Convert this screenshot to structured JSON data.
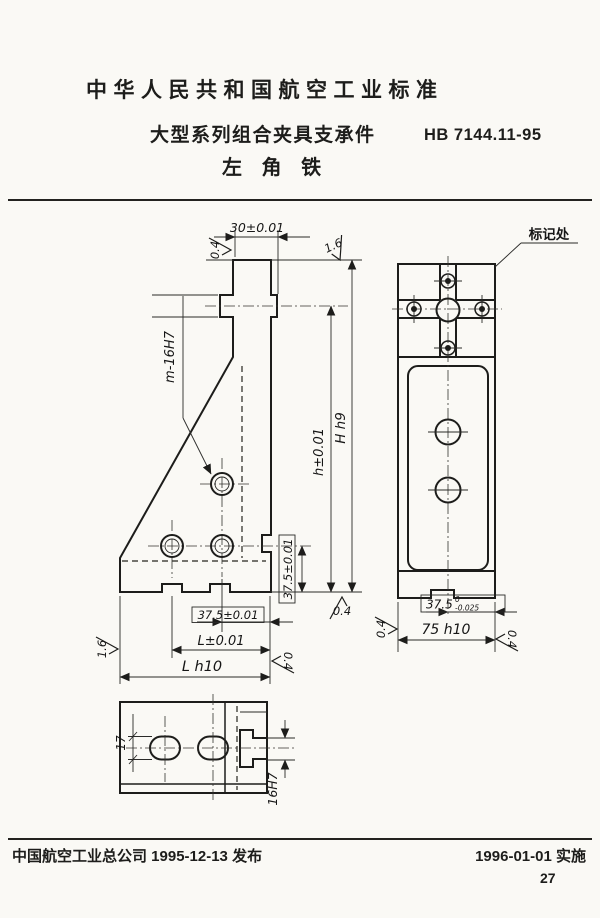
{
  "theme": {
    "paper": "#faf9f5",
    "ink": "#1d1d1b"
  },
  "header": {
    "national_standard_title": "中华人民共和国航空工业标准",
    "series_title": "大型系列组合夹具支承件",
    "standard_code": "HB 7144.11-95",
    "part_name": "左 角 铁"
  },
  "drawing": {
    "marking_callout": "标记处",
    "side_view": {
      "dim_top_width": "30±0.01",
      "roughness_top_left": "0.4",
      "roughness_top_right": "1.6",
      "holes_label": "m-16H7",
      "dim_h": "h±0.01",
      "dim_H": "H h9",
      "dim_hole_to_base": "37.5±0.01",
      "dim_slot_spacing": "37.5±0.01",
      "dim_L": "L±0.01",
      "dim_L_overall": "L h10",
      "roughness_base": "0.4",
      "roughness_left_edge": "1.6",
      "roughness_right_edge": "0.4"
    },
    "front_view": {
      "dim_slot_offset_value": "37.5",
      "dim_slot_offset_tol_upper": "0",
      "dim_slot_offset_tol_lower": "-0.025",
      "dim_width": "75 h10",
      "roughness_left": "0.4",
      "roughness_right": "0.4"
    },
    "bottom_view": {
      "dim_slot_width": "17",
      "dim_tslot_width": "16H7"
    }
  },
  "footer": {
    "issuer_line": "中国航空工业总公司 1995-12-13 发布",
    "effective_line": "1996-01-01 实施",
    "page_number": "27"
  }
}
